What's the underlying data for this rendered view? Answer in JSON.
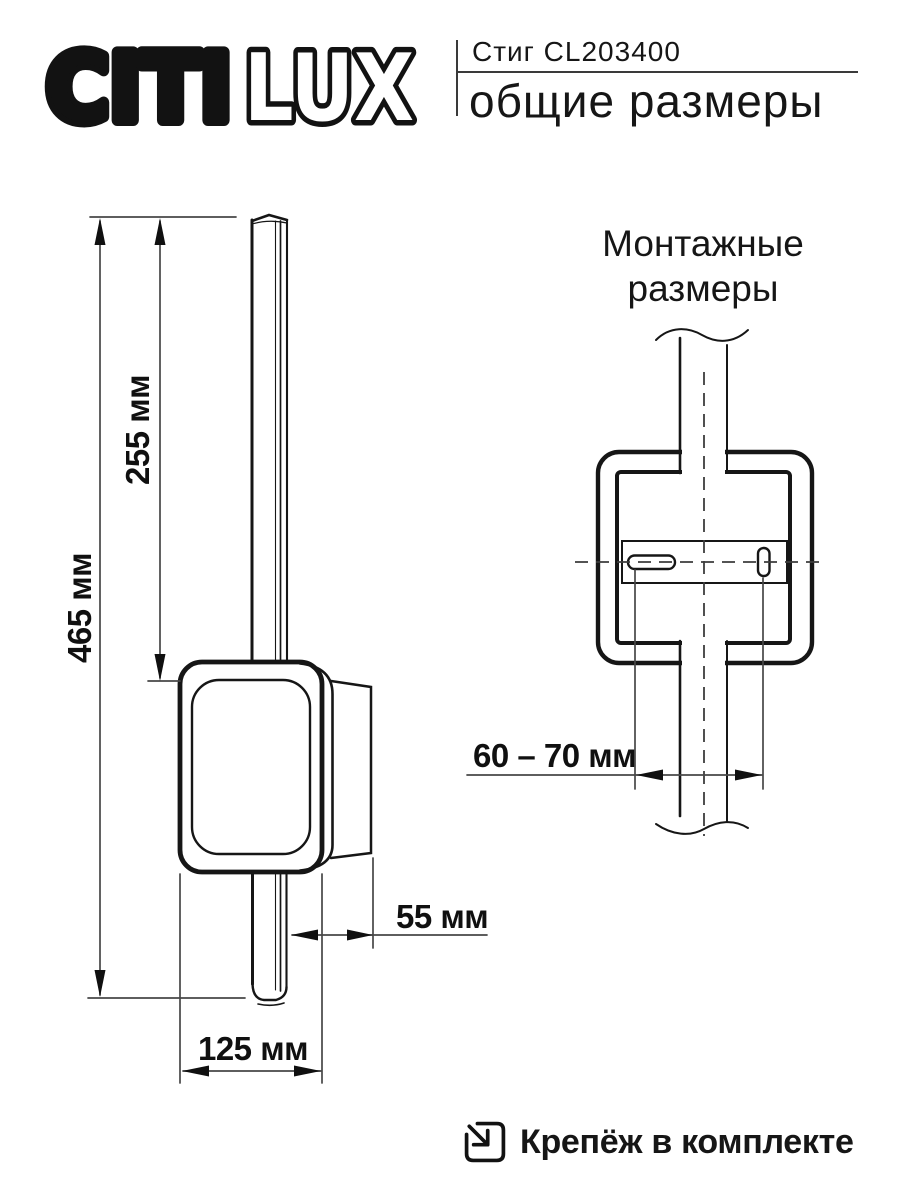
{
  "page": {
    "background": "#ffffff",
    "ink": "#161616"
  },
  "header": {
    "logo_solid": "CITI",
    "logo_outline": "LUX",
    "product_name": "Стиг CL203400",
    "page_subtitle": "общие размеры"
  },
  "general_view": {
    "labels": {
      "total_height": "465 мм",
      "upper_height": "255 мм",
      "depth": "55 мм",
      "width": "125 мм"
    }
  },
  "mounting_view": {
    "title_line1": "Монтажные",
    "title_line2": "размеры",
    "labels": {
      "hole_spacing": "60 – 70 мм"
    }
  },
  "footer": {
    "note": "Крепёж в комплекте"
  }
}
